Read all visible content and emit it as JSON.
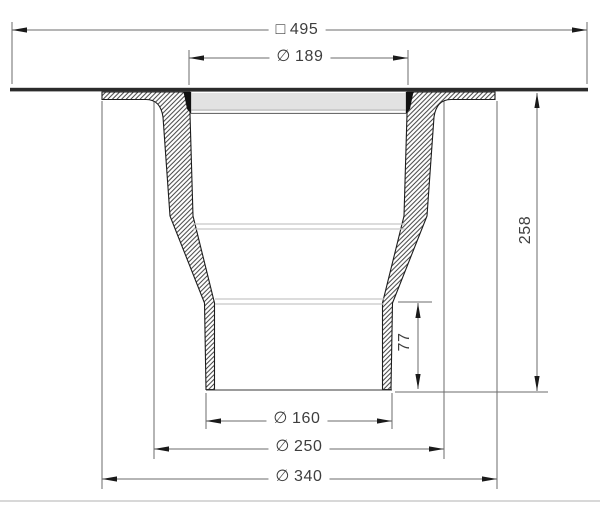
{
  "drawing": {
    "colors": {
      "outline": "#1d1d1d",
      "hatch": "#3a3a3a",
      "dimension_lines": "#6b6b6b",
      "label_text": "#3e3e3e",
      "plate": "#2b2b2b",
      "background": "#ffffff"
    },
    "dimensions": {
      "overall_width": {
        "symbol": "□",
        "value": "495"
      },
      "inlet_diameter": {
        "symbol": "∅",
        "value": "189"
      },
      "overall_height": {
        "symbol": "",
        "value": "258"
      },
      "outlet_length": {
        "symbol": "",
        "value": "77"
      },
      "outlet_diameter": {
        "symbol": "∅",
        "value": "160"
      },
      "body_diameter": {
        "symbol": "∅",
        "value": "250"
      },
      "flange_diameter": {
        "symbol": "∅",
        "value": "340"
      }
    }
  }
}
